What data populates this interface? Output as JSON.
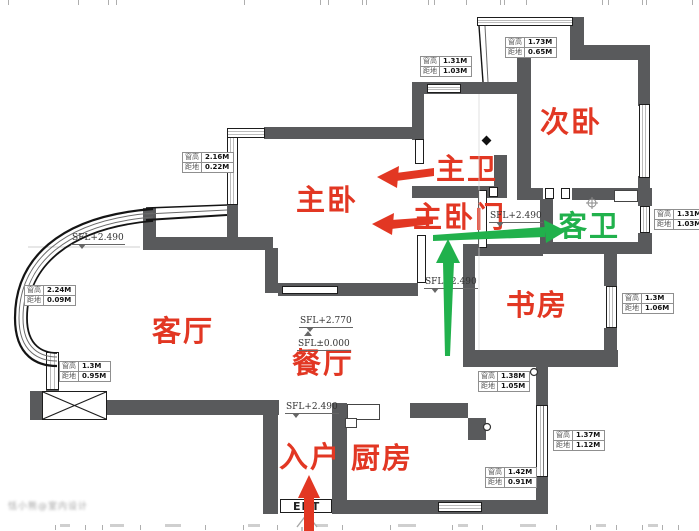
{
  "colors": {
    "wall_gray": "#595a5c",
    "label_red": "#e23723",
    "label_green": "#21b14c"
  },
  "rooms": [
    {
      "name": "主卧",
      "color": "red"
    },
    {
      "name": "次卧",
      "color": "red"
    },
    {
      "name": "主卫",
      "color": "red"
    },
    {
      "name": "主卧门",
      "color": "red"
    },
    {
      "name": "客卫",
      "color": "green"
    },
    {
      "name": "书房",
      "color": "red"
    },
    {
      "name": "客厅",
      "color": "red"
    },
    {
      "name": "餐厅",
      "color": "red"
    },
    {
      "name": "厨房",
      "color": "red"
    },
    {
      "name": "入户",
      "color": "red"
    }
  ],
  "annotations": [
    {
      "h": "窗高",
      "hv": "2.16M",
      "d": "距地",
      "dv": "0.22M"
    },
    {
      "h": "窗高",
      "hv": "1.31M",
      "d": "距地",
      "dv": "1.03M"
    },
    {
      "h": "窗高",
      "hv": "1.73M",
      "d": "距地",
      "dv": "0.65M"
    },
    {
      "h": "窗高",
      "hv": "1.31M",
      "d": "距地",
      "dv": "1.03M"
    },
    {
      "h": "窗高",
      "hv": "1.3M",
      "d": "距地",
      "dv": "1.06M"
    },
    {
      "h": "窗高",
      "hv": "2.24M",
      "d": "距地",
      "dv": "0.09M"
    },
    {
      "h": "窗高",
      "hv": "1.3M",
      "d": "距地",
      "dv": "0.95M"
    },
    {
      "h": "窗高",
      "hv": "1.38M",
      "d": "距地",
      "dv": "1.05M"
    },
    {
      "h": "窗高",
      "hv": "1.37M",
      "d": "距地",
      "dv": "1.12M"
    },
    {
      "h": "窗高",
      "hv": "1.42M",
      "d": "距地",
      "dv": "0.91M"
    }
  ],
  "sfl_markers": [
    {
      "text": "SFL+2.490"
    },
    {
      "text": "SFL+2.770"
    },
    {
      "text": "SFL±0.000"
    },
    {
      "text": "SFL+2.490"
    },
    {
      "text": "SFL+2.490"
    },
    {
      "text": "SFL+2.490"
    }
  ],
  "entrance": {
    "door_label": "ENT"
  },
  "watermark": {
    "text": "恬小熊@室内设计"
  }
}
